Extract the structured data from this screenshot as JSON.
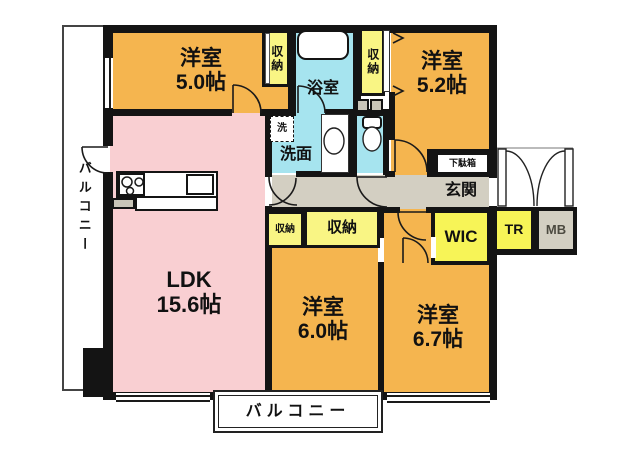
{
  "colors": {
    "wall": "#141414",
    "room": "#F5B54F",
    "ldk": "#F9CFD2",
    "closet": "#F9F584",
    "closet_bright": "#F7F457",
    "wet": "#A6E4EF",
    "hall": "#D3CFC2",
    "fixture_gray": "#C9C5B8",
    "text": "#111111",
    "mb_text": "#4C4A40"
  },
  "labels": {
    "room_nw": {
      "name": "洋室",
      "size": "5.0帖"
    },
    "room_ne": {
      "name": "洋室",
      "size": "5.2帖"
    },
    "room_s": {
      "name": "洋室",
      "size": "6.0帖"
    },
    "room_se": {
      "name": "洋室",
      "size": "6.7帖"
    },
    "ldk": {
      "name": "LDK",
      "size": "15.6帖"
    },
    "bath": "浴室",
    "washroom": "洗面",
    "washer": "洗",
    "entrance": "玄関",
    "shoe_cabinet": "下駄箱",
    "walk_in_closet": "WIC",
    "trunk_room": "TR",
    "meter_box": "MB",
    "closet": "収納",
    "balcony": "バルコニー"
  }
}
